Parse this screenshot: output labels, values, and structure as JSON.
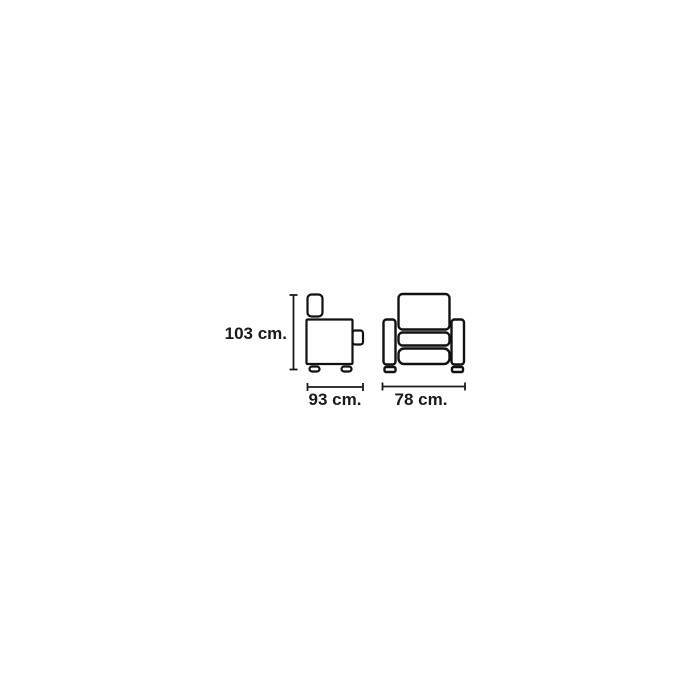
{
  "diagram": {
    "subject": "armchair-dimension-diagram",
    "background_color": "#ffffff",
    "line_color": "#1a1a1a",
    "views": [
      "side",
      "front"
    ],
    "dimensions": {
      "height": {
        "value": 103,
        "unit": "cm",
        "label": "103 cm."
      },
      "depth": {
        "value": 93,
        "unit": "cm",
        "label": "93 cm."
      },
      "width": {
        "value": 78,
        "unit": "cm",
        "label": "78 cm."
      }
    }
  }
}
